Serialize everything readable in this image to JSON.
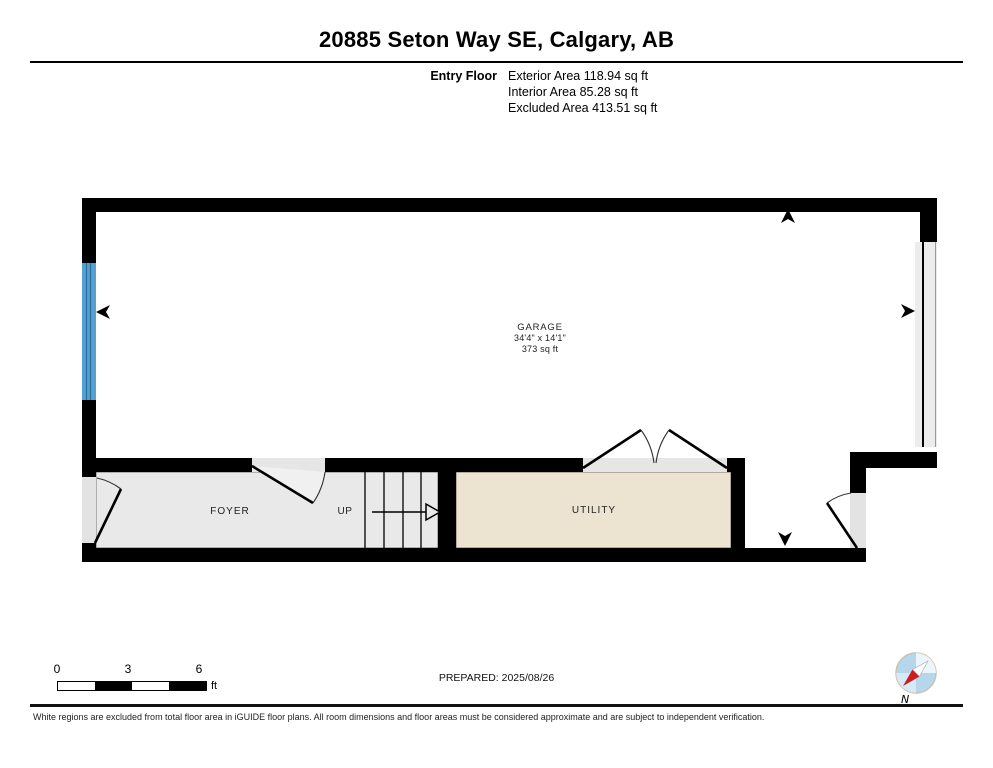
{
  "page": {
    "title": "20885 Seton Way SE, Calgary, AB"
  },
  "header": {
    "floor_label": "Entry Floor",
    "area_lines": [
      {
        "text": "Exterior Area 118.94 sq ft"
      },
      {
        "text": "Interior Area 85.28 sq ft"
      },
      {
        "text": "Excluded Area 413.51 sq ft"
      }
    ]
  },
  "rooms": {
    "garage": {
      "name": "GARAGE",
      "dimensions": "34'4\" x 14'1\"",
      "area": "373 sq ft"
    },
    "foyer": {
      "name": "FOYER"
    },
    "stairs": {
      "direction_label": "UP"
    },
    "utility": {
      "name": "UTILITY"
    }
  },
  "footer": {
    "scale_bar": {
      "ticks": [
        "0",
        "3",
        "6"
      ],
      "unit": "ft"
    },
    "prepared": "PREPARED: 2025/08/26",
    "compass_label": "N",
    "disclaimer": "White regions are excluded from total floor area in iGUIDE floor plans. All room dimensions and floor areas must be considered approximate and are subject to independent verification."
  },
  "icons": {
    "compass": "compass-rose-icon",
    "entrance_markers": [
      "arrow-up-icon",
      "arrow-left-icon",
      "arrow-right-icon",
      "arrow-down-icon"
    ]
  },
  "colors": {
    "wall": "#000000",
    "window_blue": "#57a0d2",
    "window_blue_dark": "#2b6d9c",
    "floor_gray": "#e9e9e9",
    "floor_beige": "#ece3d1",
    "opening_gray": "#e3e3e3",
    "compass_blue": "#b5d7ee",
    "compass_red": "#cf1b1b"
  }
}
